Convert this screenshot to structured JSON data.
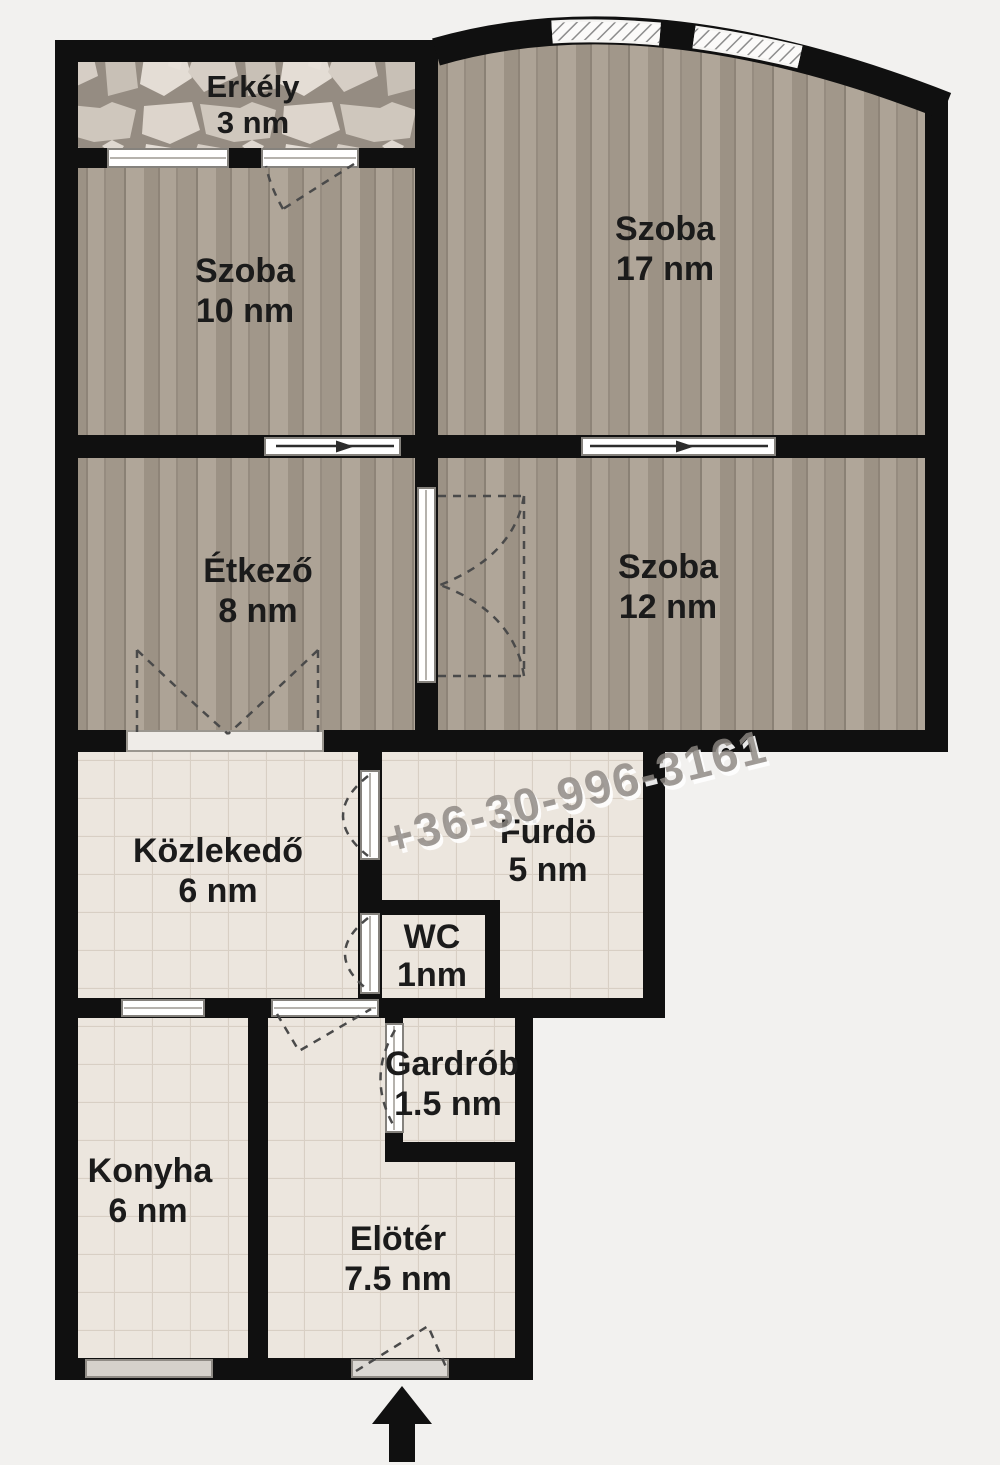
{
  "floorplan": {
    "watermark": "+36-30-996-3161",
    "rooms": [
      {
        "id": "erkely",
        "name": "Erkély",
        "area": "3 nm"
      },
      {
        "id": "szoba10",
        "name": "Szoba",
        "area": "10 nm"
      },
      {
        "id": "szoba17",
        "name": "Szoba",
        "area": "17 nm"
      },
      {
        "id": "etkezo",
        "name": "Étkező",
        "area": "8 nm"
      },
      {
        "id": "szoba12",
        "name": "Szoba",
        "area": "12 nm"
      },
      {
        "id": "kozlekedo",
        "name": "Közlekedő",
        "area": "6 nm"
      },
      {
        "id": "furdo",
        "name": "Fürdö",
        "area": "5 nm"
      },
      {
        "id": "wc",
        "name": "WC",
        "area": "1nm"
      },
      {
        "id": "gardrob",
        "name": "Gardrób",
        "area": "1.5 nm"
      },
      {
        "id": "konyha",
        "name": "Konyha",
        "area": "6 nm"
      },
      {
        "id": "eloter",
        "name": "Elötér",
        "area": "7.5 nm"
      }
    ],
    "icons": {
      "entrance_arrow": "arrow-up"
    },
    "colors": {
      "background": "#f2f1ef",
      "wall": "#101010",
      "wood_floor": "#a79d91",
      "tile_floor": "#eae3db",
      "stone_floor": "#958c82",
      "window_frame": "#ffffff",
      "watermark_gray": "#8d8883",
      "label_text": "#1b1b1b"
    }
  }
}
